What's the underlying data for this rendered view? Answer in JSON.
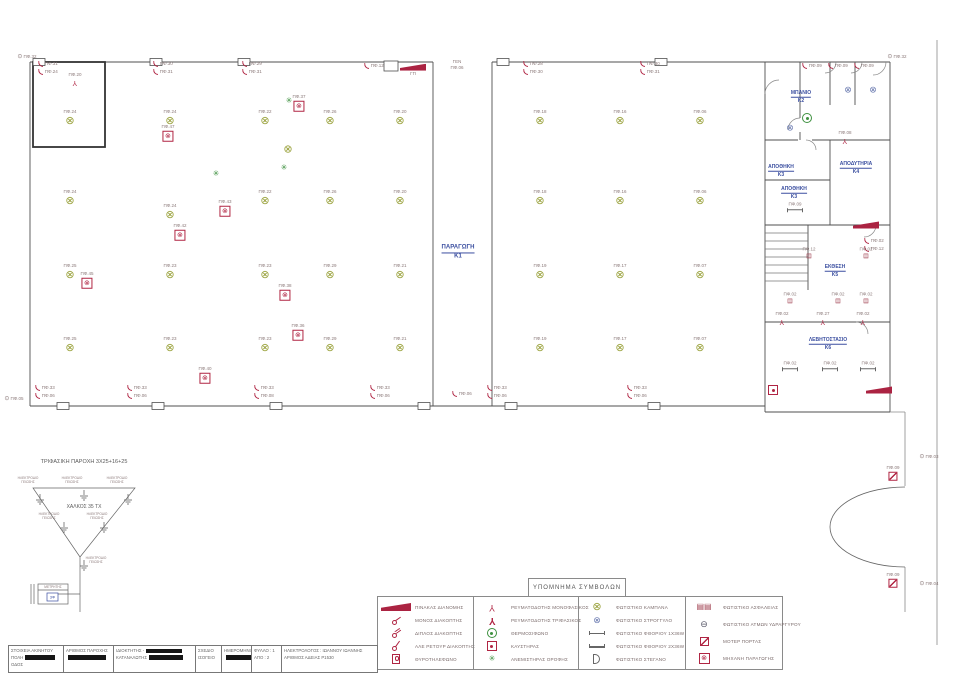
{
  "legend": {
    "title": "ΥΠΟΜΝΗΜΑ ΣΥΜΒΟΛΩΝ",
    "columns": [
      {
        "items": [
          {
            "sym": "panel",
            "label": "ΠΙΝΑΚΑΣ ΔΙΑΝΟΜΗΣ"
          },
          {
            "sym": "switch1",
            "label": "ΜΟΝΟΣ ΔΙΑΚΟΠΤΗΣ"
          },
          {
            "sym": "switch2",
            "label": "ΔΙΠΛΟΣ ΔΙΑΚΟΠΤΗΣ"
          },
          {
            "sym": "switchar",
            "label": "ΑΛΕ ΡΕΤΟΥΡ ΔΙΑΚΟΠΤΗΣ"
          },
          {
            "sym": "doorphone",
            "label": "ΘΥΡΟΤΗΛΕΦΩΝΟ"
          }
        ]
      },
      {
        "items": [
          {
            "sym": "socket1",
            "label": "ΡΕΥΜΑΤΟΔΟΤΗΣ ΜΟΝΟΦΑΣΙΚΟΣ"
          },
          {
            "sym": "socket3",
            "label": "ΡΕΥΜΑΤΟΔΟΤΗΣ ΤΡΙΦΑΣΙΚΟΣ"
          },
          {
            "sym": "thermo",
            "label": "ΘΕΡΜΟΣΙΦΩΝΟ"
          },
          {
            "sym": "burner",
            "label": "ΚΑΥΣΤΗΡΑΣ"
          },
          {
            "sym": "fan",
            "label": "ΑΝΕΜΙΣΤΗΡΑΣ ΟΡΟΦΗΣ"
          }
        ]
      },
      {
        "items": [
          {
            "sym": "light",
            "label": "ΦΩΤΙΣΤΙΚΟ  ΚΑΜΠΑΝΑ"
          },
          {
            "sym": "round",
            "label": "ΦΩΤΙΣΤΙΚΟ ΣΤΡΟΓΓΥΛΟ"
          },
          {
            "sym": "fluor1",
            "label": "ΦΩΤΙΣΤΙΚΟ ΦΘΟΡΙΟΥ 1Χ36W"
          },
          {
            "sym": "fluor2",
            "label": "ΦΩΤΙΣΤΙΚΟ ΦΘΟΡΙΟΥ 2Χ36W"
          },
          {
            "sym": "sealed",
            "label": "ΦΩΤΙΣΤΙΚΟ ΣΤΕΓΑΝΟ"
          }
        ]
      },
      {
        "items": [
          {
            "sym": "safety",
            "label": "ΦΩΤΙΣΤΙΚΟ ΑΣΦΑΛΕΙΑΣ"
          },
          {
            "sym": "mercury",
            "label": "ΦΩΤΙΣΤΙΚΟ ΑΤΜΩΝ ΥΔΡΑΡΓΥΡΟΥ"
          },
          {
            "sym": "motor",
            "label": "ΜΟΤΕΡ ΠΟΡΤΑΣ"
          },
          {
            "sym": "machine",
            "label": "ΜΗΧΑΝΗ ΠΑΡΑΓΩΓΗΣ"
          }
        ]
      }
    ]
  },
  "title_block": {
    "cells": [
      {
        "w": 54,
        "lines": [
          {
            "t": "ΣΤΟΙΧΕΙΑ ΑΚΙΝΗΤΟΥ",
            "r": 0
          },
          {
            "t": "ΠΟΛΗ",
            "r": 30
          },
          {
            "t": "ΟΔΟΣ",
            "r": 0
          }
        ]
      },
      {
        "w": 50,
        "lines": [
          {
            "t": "ΑΡΙΘΜΟΣ ΠΑΡΟΧΗΣ",
            "r": 0
          },
          {
            "t": "",
            "r": 38
          }
        ]
      },
      {
        "w": 82,
        "lines": [
          {
            "t": "ΙΔΙΟΚΤΗΤΗΣ -",
            "r": 36
          },
          {
            "t": "ΚΑΤΑΝΑΛΩΤΗΣ",
            "r": 34
          }
        ]
      },
      {
        "w": 26,
        "lines": [
          {
            "t": "ΣΧΕΔΙΟ",
            "r": 0
          },
          {
            "t": "ΙΣΟΓΕΙΟ",
            "r": 0
          }
        ]
      },
      {
        "w": 30,
        "lines": [
          {
            "t": "ΗΜΕΡΟΜΗΝΙΑ",
            "r": 0
          },
          {
            "t": "",
            "r": 26
          }
        ]
      },
      {
        "w": 30,
        "lines": [
          {
            "t": "ΦΥΛΛΟ : 1",
            "r": 0
          },
          {
            "t": "ΑΠΟ : 2",
            "r": 0
          }
        ]
      },
      {
        "w": 96,
        "lines": [
          {
            "t": "ΗΛΕΚΤΡΟΛΟΓΟΣ : ΙΩΑΝΝΟΥ ΙΩΑΝΝΗΣ",
            "r": 0
          },
          {
            "t": "ΑΡΙΘΜΟΣ ΑΔΕΙΑΣ Ρ1530",
            "r": 0
          }
        ]
      }
    ]
  },
  "supply": {
    "title": "ΤΡΙΦΑΣΙΚΗ ΠΑΡΟΧΗ 3Χ25+16+25",
    "conductor": "ΧΑΛΚΟΣ 35 ΤΧ",
    "electrode": "ΗΛΕΚΤΡΟΔΙΟ ΓΕΙΩΣΗΣ",
    "meter": "ΜΕΤΡΗΤΗΣ",
    "meter_type": "3Φ"
  },
  "plan": {
    "rooms": [
      {
        "name": "ΠΑΡΑΓΩΓΗ",
        "code": "Κ1",
        "x": 458,
        "y": 253,
        "big": true
      },
      {
        "name": "ΜΠΑΝΙΟ",
        "code": "Κ2",
        "x": 801,
        "y": 97
      },
      {
        "name": "ΑΠΟΘΗΚΗ",
        "code": "Κ3",
        "x": 781,
        "y": 171
      },
      {
        "name": "ΑΠΟΘΗΚΗ",
        "code": "Κ3",
        "x": 794,
        "y": 193
      },
      {
        "name": "ΑΠΟΔΥΤΗΡΙΑ",
        "code": "Κ4",
        "x": 856,
        "y": 168
      },
      {
        "name": "ΕΚΘΕΣΗ",
        "code": "Κ5",
        "x": 835,
        "y": 271
      },
      {
        "name": "ΛΕΒΗΤΟΣΤΑΣΙΟ",
        "code": "Κ6",
        "x": 828,
        "y": 344
      }
    ],
    "symbols": [
      {
        "k": "light",
        "x": 70,
        "y": 118,
        "l": "ΠΦ.24"
      },
      {
        "k": "light",
        "x": 170,
        "y": 118,
        "l": "ΠΦ.24"
      },
      {
        "k": "light",
        "x": 265,
        "y": 118,
        "l": "ΠΦ.22"
      },
      {
        "k": "light",
        "x": 330,
        "y": 118,
        "l": "ΠΦ.26"
      },
      {
        "k": "light",
        "x": 400,
        "y": 118,
        "l": "ΠΦ.20"
      },
      {
        "k": "light",
        "x": 70,
        "y": 198,
        "l": "ΠΦ.24"
      },
      {
        "k": "light",
        "x": 170,
        "y": 212,
        "l": "ΠΦ.24"
      },
      {
        "k": "light",
        "x": 265,
        "y": 198,
        "l": "ΠΦ.22"
      },
      {
        "k": "light",
        "x": 330,
        "y": 198,
        "l": "ΠΦ.26"
      },
      {
        "k": "light",
        "x": 400,
        "y": 198,
        "l": "ΠΦ.20"
      },
      {
        "k": "light",
        "x": 288,
        "y": 150,
        "l": ""
      },
      {
        "k": "light",
        "x": 70,
        "y": 272,
        "l": "ΠΦ.25"
      },
      {
        "k": "light",
        "x": 170,
        "y": 272,
        "l": "ΠΦ.23"
      },
      {
        "k": "light",
        "x": 265,
        "y": 272,
        "l": "ΠΦ.23"
      },
      {
        "k": "light",
        "x": 330,
        "y": 272,
        "l": "ΠΦ.29"
      },
      {
        "k": "light",
        "x": 400,
        "y": 272,
        "l": "ΠΦ.21"
      },
      {
        "k": "light",
        "x": 70,
        "y": 345,
        "l": "ΠΦ.25"
      },
      {
        "k": "light",
        "x": 170,
        "y": 345,
        "l": "ΠΦ.23"
      },
      {
        "k": "light",
        "x": 265,
        "y": 345,
        "l": "ΠΦ.23"
      },
      {
        "k": "light",
        "x": 330,
        "y": 345,
        "l": "ΠΦ.29"
      },
      {
        "k": "light",
        "x": 400,
        "y": 345,
        "l": "ΠΦ.21"
      },
      {
        "k": "light",
        "x": 540,
        "y": 118,
        "l": "ΠΦ.18"
      },
      {
        "k": "light",
        "x": 620,
        "y": 118,
        "l": "ΠΦ.16"
      },
      {
        "k": "light",
        "x": 700,
        "y": 118,
        "l": "ΠΦ.06"
      },
      {
        "k": "light",
        "x": 540,
        "y": 198,
        "l": "ΠΦ.18"
      },
      {
        "k": "light",
        "x": 620,
        "y": 198,
        "l": "ΠΦ.16"
      },
      {
        "k": "light",
        "x": 700,
        "y": 198,
        "l": "ΠΦ.06"
      },
      {
        "k": "light",
        "x": 540,
        "y": 272,
        "l": "ΠΦ.19"
      },
      {
        "k": "light",
        "x": 620,
        "y": 272,
        "l": "ΠΦ.17"
      },
      {
        "k": "light",
        "x": 700,
        "y": 272,
        "l": "ΠΦ.07"
      },
      {
        "k": "light",
        "x": 540,
        "y": 345,
        "l": "ΠΦ.19"
      },
      {
        "k": "light",
        "x": 620,
        "y": 345,
        "l": "ΠΦ.17"
      },
      {
        "k": "light",
        "x": 700,
        "y": 345,
        "l": "ΠΦ.07"
      },
      {
        "k": "machine",
        "x": 299,
        "y": 103,
        "l": "ΠΦ.37"
      },
      {
        "k": "machine",
        "x": 168,
        "y": 133,
        "l": "ΠΦ.47"
      },
      {
        "k": "machine",
        "x": 87,
        "y": 280,
        "l": "ΠΦ.45"
      },
      {
        "k": "machine",
        "x": 225,
        "y": 208,
        "l": "ΠΦ.43"
      },
      {
        "k": "machine",
        "x": 180,
        "y": 232,
        "l": "ΠΦ.42"
      },
      {
        "k": "machine",
        "x": 285,
        "y": 292,
        "l": "ΠΦ.38"
      },
      {
        "k": "machine",
        "x": 298,
        "y": 332,
        "l": "ΠΦ.36"
      },
      {
        "k": "machine",
        "x": 205,
        "y": 375,
        "l": "ΠΦ.40"
      },
      {
        "k": "fan",
        "x": 289,
        "y": 101,
        "l": ""
      },
      {
        "k": "fan",
        "x": 216,
        "y": 174,
        "l": ""
      },
      {
        "k": "fan",
        "x": 284,
        "y": 168,
        "l": ""
      },
      {
        "k": "sw2",
        "x": 48,
        "y": 68,
        "l": "ΠΦ.31",
        "l2": "ΠΦ.24"
      },
      {
        "k": "sw2",
        "x": 163,
        "y": 68,
        "l": "ΠΦ.30",
        "l2": "ΠΦ.31"
      },
      {
        "k": "sw2",
        "x": 252,
        "y": 68,
        "l": "ΠΦ.29",
        "l2": "ΠΦ.31"
      },
      {
        "k": "sw2",
        "x": 374,
        "y": 66,
        "l": "ΠΦ.12",
        "l2": ""
      },
      {
        "k": "sw2",
        "x": 533,
        "y": 68,
        "l": "ΠΦ.28",
        "l2": "ΠΦ.30"
      },
      {
        "k": "sw2",
        "x": 650,
        "y": 68,
        "l": "ΠΦ.30",
        "l2": "ΠΦ.31"
      },
      {
        "k": "sw2",
        "x": 812,
        "y": 66,
        "l": "ΠΦ.09",
        "l2": ""
      },
      {
        "k": "sw2",
        "x": 838,
        "y": 66,
        "l": "ΠΦ.09",
        "l2": ""
      },
      {
        "k": "sw2",
        "x": 864,
        "y": 66,
        "l": "ΠΦ.09",
        "l2": ""
      },
      {
        "k": "sw2",
        "x": 874,
        "y": 245,
        "l": "ΠΦ.02",
        "l2": "ΠΦ.12"
      },
      {
        "k": "sw2",
        "x": 45,
        "y": 392,
        "l": "ΠΦ.33",
        "l2": "ΠΦ.06"
      },
      {
        "k": "sw2",
        "x": 137,
        "y": 392,
        "l": "ΠΦ.33",
        "l2": "ΠΦ.06"
      },
      {
        "k": "sw2",
        "x": 264,
        "y": 392,
        "l": "ΠΦ.33",
        "l2": "ΠΦ.08"
      },
      {
        "k": "sw2",
        "x": 380,
        "y": 392,
        "l": "ΠΦ.33",
        "l2": "ΠΦ.06"
      },
      {
        "k": "sw2",
        "x": 462,
        "y": 394,
        "l": "ΠΦ.06",
        "l2": ""
      },
      {
        "k": "sw2",
        "x": 497,
        "y": 392,
        "l": "ΠΦ.33",
        "l2": "ΠΦ.06"
      },
      {
        "k": "sw2",
        "x": 637,
        "y": 392,
        "l": "ΠΦ.33",
        "l2": "ΠΦ.06"
      },
      {
        "k": "socket",
        "x": 75,
        "y": 79,
        "l": "ΠΦ.20"
      },
      {
        "k": "socket",
        "x": 845,
        "y": 137,
        "l": "ΠΦ.08"
      },
      {
        "k": "socket",
        "x": 782,
        "y": 318,
        "l": "ΠΦ.02"
      },
      {
        "k": "socket",
        "x": 823,
        "y": 318,
        "l": "ΠΦ.27"
      },
      {
        "k": "socket",
        "x": 863,
        "y": 318,
        "l": "ΠΦ.02"
      },
      {
        "k": "thermo",
        "x": 807,
        "y": 118,
        "l": ""
      },
      {
        "k": "round",
        "x": 848,
        "y": 90,
        "l": ""
      },
      {
        "k": "round",
        "x": 873,
        "y": 90,
        "l": ""
      },
      {
        "k": "round",
        "x": 790,
        "y": 128,
        "l": ""
      },
      {
        "k": "safety",
        "x": 809,
        "y": 253,
        "l": "ΠΦ.12"
      },
      {
        "k": "safety",
        "x": 866,
        "y": 253,
        "l": "ΠΦ.02"
      },
      {
        "k": "safety",
        "x": 790,
        "y": 298,
        "l": "ΠΦ.02"
      },
      {
        "k": "safety",
        "x": 838,
        "y": 298,
        "l": "ΠΦ.02"
      },
      {
        "k": "safety",
        "x": 866,
        "y": 298,
        "l": "ΠΦ.02"
      },
      {
        "k": "fluor",
        "x": 795,
        "y": 207,
        "l": "ΠΦ.09"
      },
      {
        "k": "fluor",
        "x": 790,
        "y": 366,
        "l": "ΠΦ.02"
      },
      {
        "k": "fluor",
        "x": 830,
        "y": 366,
        "l": "ΠΦ.02"
      },
      {
        "k": "fluor",
        "x": 868,
        "y": 366,
        "l": "ΠΦ.02"
      },
      {
        "k": "burner",
        "x": 773,
        "y": 390,
        "l": ""
      },
      {
        "k": "motor",
        "x": 893,
        "y": 473,
        "l": "ΠΦ.09"
      },
      {
        "k": "motor",
        "x": 893,
        "y": 580,
        "l": "ΠΦ.09"
      },
      {
        "k": "panel",
        "x": 413,
        "y": 70,
        "l": "ΓΠ"
      },
      {
        "k": "panel",
        "x": 866,
        "y": 225,
        "l": ""
      },
      {
        "k": "panel",
        "x": 879,
        "y": 390,
        "l": ""
      },
      {
        "k": "dot",
        "x": 27,
        "y": 57,
        "l": "ΠΦ.32"
      },
      {
        "k": "dot",
        "x": 14,
        "y": 399,
        "l": "ΠΦ.05"
      },
      {
        "k": "dot",
        "x": 897,
        "y": 57,
        "l": "ΠΦ.32"
      },
      {
        "k": "dot",
        "x": 929,
        "y": 457,
        "l": "ΠΦ.03"
      },
      {
        "k": "dot",
        "x": 929,
        "y": 584,
        "l": "ΠΦ.04"
      },
      {
        "k": "text2",
        "x": 457,
        "y": 65,
        "l": "ΓΕΝ",
        "l2": "ΠΦ.06"
      }
    ]
  }
}
